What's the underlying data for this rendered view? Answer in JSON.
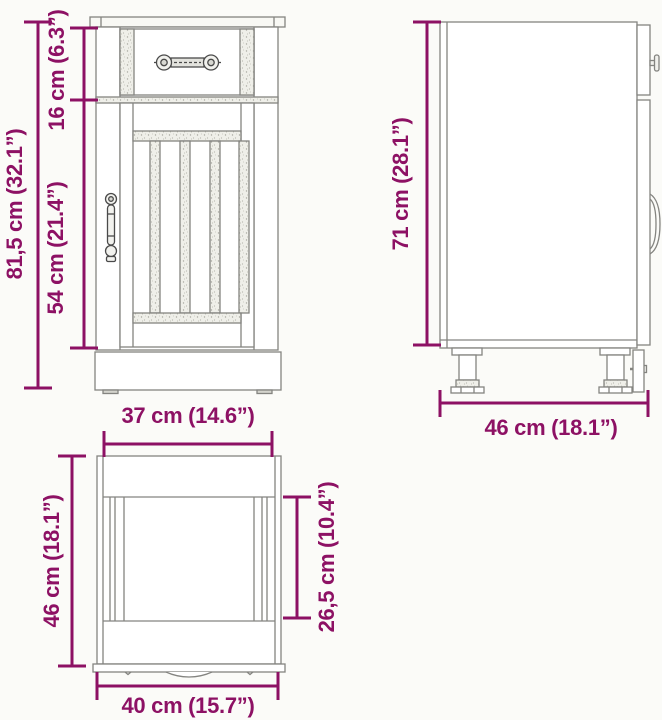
{
  "colors": {
    "dimension": "#8D1164",
    "outline": "#848480",
    "background": "#fbfbf8"
  },
  "views": {
    "front": {
      "dims": {
        "total_height": "81,5 cm (32.1”)",
        "top_section_height": "16 cm (6.3”)",
        "door_height": "54 cm (21.4”)"
      }
    },
    "side": {
      "dims": {
        "carcass_height": "71 cm (28.1”)",
        "depth": "46 cm (18.1”)"
      }
    },
    "top": {
      "dims": {
        "front_width": "37 cm (14.6”)",
        "depth": "46 cm (18.1”)",
        "inner_depth": "26,5 cm (10.4”)",
        "total_width": "40 cm (15.7”)"
      }
    }
  }
}
